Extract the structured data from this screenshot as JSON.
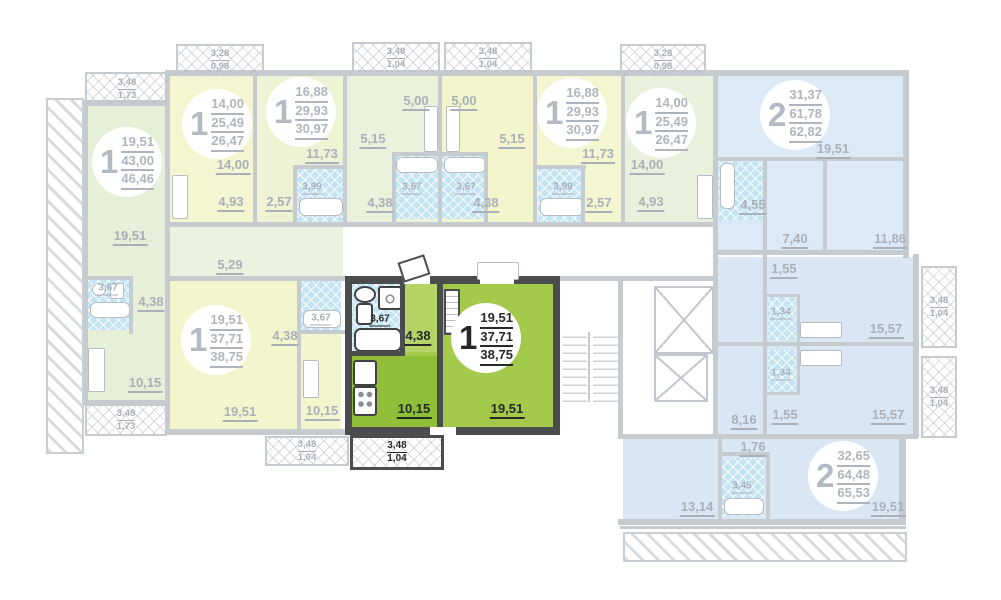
{
  "units": {
    "left": {
      "badge": "1",
      "v1": "19,51",
      "v2": "43,00",
      "v3": "46,46"
    },
    "t14l": {
      "badge": "1",
      "v1": "14,00",
      "v2": "25,49",
      "v3": "26,47"
    },
    "t1688l": {
      "badge": "1",
      "v1": "16,88",
      "v2": "29,93",
      "v3": "30,97"
    },
    "t1688r": {
      "badge": "1",
      "v1": "16,88",
      "v2": "29,93",
      "v3": "30,97"
    },
    "t14r": {
      "badge": "1",
      "v1": "14,00",
      "v2": "25,49",
      "v3": "26,47"
    },
    "t2": {
      "badge": "2",
      "v1": "31,37",
      "v2": "61,78",
      "v3": "62,82"
    },
    "y37": {
      "badge": "1",
      "v1": "19,51",
      "v2": "37,71",
      "v3": "38,75"
    },
    "hl": {
      "badge": "1",
      "v1": "19,51",
      "v2": "37,71",
      "v3": "38,75"
    },
    "b2": {
      "badge": "2",
      "v1": "32,65",
      "v2": "64,48",
      "v3": "65,53"
    }
  },
  "rooms": {
    "left_living": "19,51",
    "left_corr": "5,29",
    "left_bath": "3,67",
    "left_hall": "4,38",
    "left_kitchen": "10,15",
    "t14l_room": "14,00",
    "t14l_kitchen": "4,93",
    "t1688l_room": "11,73",
    "t1688l_bath": "3,99",
    "t1688l_hall": "2,57",
    "stl_kitchen": "5,00",
    "stl_room": "5,15",
    "stl_bath": "3,67",
    "stl_hall": "4,38",
    "str_kitchen": "5,00",
    "str_room": "5,15",
    "str_bath": "3,67",
    "str_hall": "4,38",
    "t1688r_room": "11,73",
    "t1688r_bath": "3,99",
    "t1688r_hall": "2,57",
    "t14r_room": "14,00",
    "t14r_kitchen": "4,93",
    "t2_living": "19,51",
    "t2_bath": "4,55",
    "t2_room1": "7,40",
    "t2_room2": "11,86",
    "st1_hall": "1,55",
    "st1_bath": "1,34",
    "st1_room": "15,57",
    "st2_bath": "1,34",
    "st2_hall": "1,55",
    "st2_room": "15,57",
    "corr_r": "8,16",
    "b2_hall": "1,76",
    "b2_bath": "3,45",
    "b2_room": "13,14",
    "b2_living": "19,51",
    "y37_living": "19,51",
    "y37_hall": "4,38",
    "y37_bath": "3,67",
    "y37_kitchen": "10,15",
    "hl_bath": "3,67",
    "hl_hall": "4,38",
    "hl_kitchen": "10,15",
    "hl_living": "19,51"
  },
  "balconies": {
    "tl": {
      "a": "3,48",
      "b": "1,73"
    },
    "t14l": {
      "a": "3,28",
      "b": "0,98"
    },
    "tstl": {
      "a": "3,48",
      "b": "1,04"
    },
    "tstr": {
      "a": "3,48",
      "b": "1,04"
    },
    "t14r": {
      "a": "3,28",
      "b": "0,98"
    },
    "r1": {
      "a": "3,48",
      "b": "1,04"
    },
    "r2": {
      "a": "3,48",
      "b": "1,04"
    },
    "bl": {
      "a": "3,48",
      "b": "1,73"
    },
    "by": {
      "a": "3,48",
      "b": "1,04"
    },
    "bhl": {
      "a": "3,48",
      "b": "1,04"
    }
  },
  "colors": {
    "highlight_green": "#9cc63f",
    "highlight_kitchen": "#8fbe37",
    "highlight_hall": "#b4d466",
    "wall_gray": "#c6cbd0",
    "wall_dark": "#4a4c4e",
    "pale_yellow": "#f3f6d0",
    "pale_green": "#e6efd8",
    "pale_blue": "#dce9f6",
    "tile_blue": "#c5e4f3",
    "label_gray": "#a9b0b8",
    "label_dark": "#26282a"
  }
}
